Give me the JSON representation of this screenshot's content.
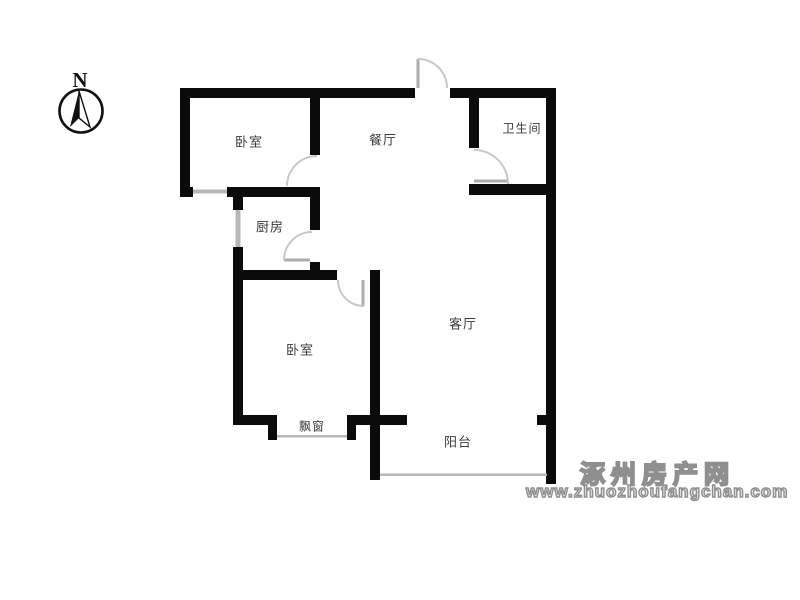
{
  "compass": {
    "label": "N"
  },
  "rooms": [
    {
      "id": "bedroom-1",
      "label": "卧室"
    },
    {
      "id": "dining-room",
      "label": "餐厅"
    },
    {
      "id": "bathroom",
      "label": "卫生间"
    },
    {
      "id": "kitchen",
      "label": "厨房"
    },
    {
      "id": "bedroom-2",
      "label": "卧室"
    },
    {
      "id": "living-room",
      "label": "客厅"
    },
    {
      "id": "balcony",
      "label": "阳台"
    },
    {
      "id": "bay-window",
      "label": "飘窗"
    }
  ],
  "watermark": {
    "line1": "涿州房产网",
    "line2": "www.zhuozhoufangchan.com"
  },
  "colors": {
    "wall": "#0b0b0b",
    "window": "#b7b7b7",
    "door": "#c8c8c8",
    "label_text": "#3a3a3a",
    "watermark": "#8f8f8f",
    "background": "#ffffff"
  }
}
